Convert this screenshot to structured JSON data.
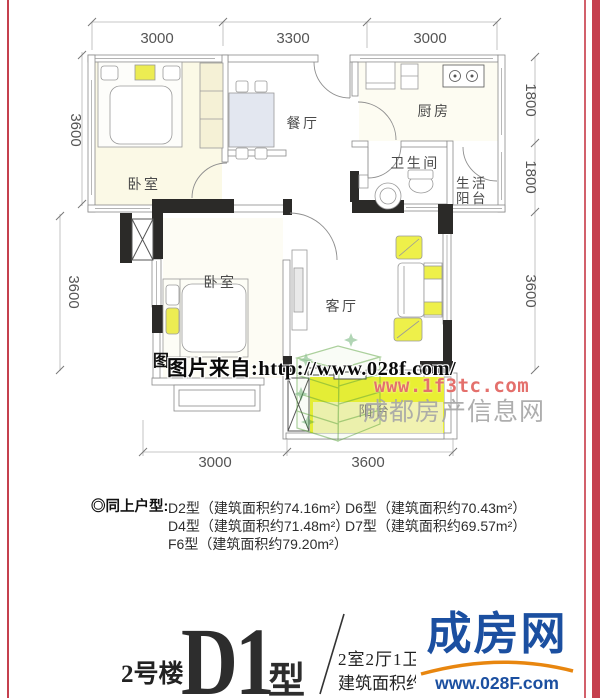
{
  "plan": {
    "room_labels": {
      "bedroom1": "卧室",
      "dining": "餐厅",
      "kitchen": "厨房",
      "bathroom": "卫生间",
      "service_balcony_line1": "生活",
      "service_balcony_line2": "阳台",
      "bedroom2": "卧室",
      "living": "客厅",
      "balcony": "阳台"
    },
    "dimensions": {
      "top": [
        "3000",
        "3300",
        "3000"
      ],
      "left": [
        "3600",
        "3600"
      ],
      "right": [
        "1800",
        "1800",
        "3600"
      ],
      "bottom": [
        "3000",
        "3600"
      ]
    }
  },
  "watermarks": {
    "partial_char": "图",
    "source_url": "图片来自:http://www.028f.com/",
    "site_url": "www.1f3tc.com",
    "site_name": "成都房产信息网"
  },
  "similar_units": {
    "label": "◎同上户型:",
    "col1": [
      "D2型（建筑面积约74.16m²）",
      "D4型（建筑面积约71.48m²）",
      "F6型（建筑面积约79.20m²）"
    ],
    "col2": [
      "D6型（建筑面积约70.43m²）",
      "D7型（建筑面积约69.57m²）"
    ]
  },
  "title_block": {
    "building": "2号楼",
    "unit": "D1",
    "unit_suffix": "型",
    "layout": "2室2厅1卫",
    "area": "建筑面积约71.58m²"
  },
  "logo": {
    "name": "成房网",
    "url": "www.028F.com"
  },
  "colors": {
    "accent_red": "#c5404e",
    "balcony_yellow": "#e9ef33",
    "logo_blue": "#1b4fa0",
    "logo_orange": "#e8860f",
    "watermark_red": "#e4706c"
  }
}
